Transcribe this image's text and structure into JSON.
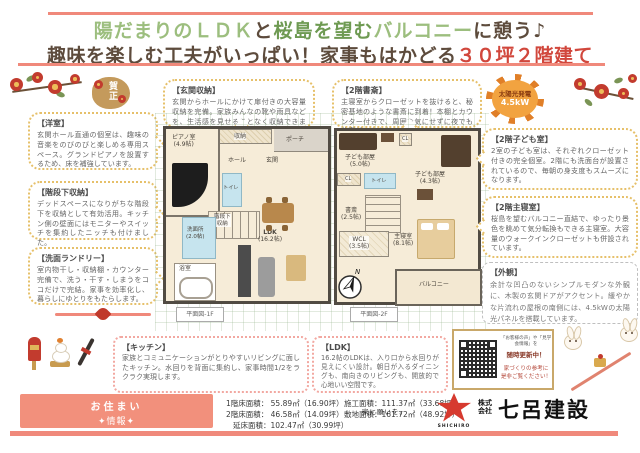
{
  "colors": {
    "accent_salmon": "#F0897B",
    "title_green": "#9CBE7E",
    "title_dark_green": "#6E9A52",
    "title_brown": "#5D4B3C",
    "highlight_red": "#D1473C",
    "brand_red": "#D63A2F"
  },
  "title": {
    "l1s1": "陽だまりの",
    "l1s2": "ＬＤＫ",
    "l1s3": "と",
    "l1s4": "桜島を望む",
    "l1s5": "バルコニー",
    "l1s6": "に憩う♪",
    "l2s1": "趣味を楽しむ工夫がいっぱい！家事もはかどる",
    "l2s2": "３０坪２階建て"
  },
  "seal": {
    "text": "賀正"
  },
  "solar": {
    "label": "太陽光発電",
    "value": "4.5kW"
  },
  "bubbles": {
    "genkan": {
      "title": "【玄関収納】",
      "body": "玄関からホールにかけて扉付きの大容量収納を完備。家族みんなの靴や雨具などを、生活感を見せることなく収納できます。"
    },
    "shosai": {
      "title": "【2階書斎】",
      "body": "主寝室からクローゼットを抜けると、秘密基地のような書斎に到着！本棚とカウンター付きで、周囲を気にせずに夜でも仕事ができます。"
    },
    "yoshitsu": {
      "title": "【洋室】",
      "body": "玄関ホール直通の個室は、趣味の音楽をのびのびと楽しめる専用スペース。グランドピアノを設置するため、床を補強しています。"
    },
    "kaidan": {
      "title": "【階段下収納】",
      "body": "デッドスペースになりがちな階段下を収納として有効活用。キッチン側の壁面にはモニターやスイッチを集約したニッチも付けました。"
    },
    "senmen": {
      "title": "【洗面ランドリー】",
      "body": "室内物干し・収納棚・カウンター完備で、洗う・干す・しまうをココだけで完結。家事を効率化し、暮らしにゆとりをもたらします。"
    },
    "kodomo": {
      "title": "【2階子ども室】",
      "body": "2室の子ども室は、それぞれクローゼット付きの完全個室。2階にも洗面台が設置されているので、毎朝の身支度もスムーズになります。"
    },
    "shinshitsu": {
      "title": "【2階主寝室】",
      "body": "桜島を望むバルコニー直結で、ゆったり景色を眺めて気分転換もできる主寝室。大容量のウォークインクローゼットも併設されています。"
    },
    "gaikan": {
      "title": "【外観】",
      "body": "余計な凹凸のないシンプルモダンな外観に、木製の玄関ドアがアクセント。緩やかな片流れの屋根の南側には、4.5kWの太陽光パネルを搭載しています。"
    },
    "kitchen": {
      "title": "【キッチン】",
      "body": "家族とコミュニケーションがとりやすいリビングに面したキッチン。水回りを背面に集約し、家事時間1/2をラクラク実現します。"
    },
    "ldk": {
      "title": "【LDK】",
      "body": "16.2帖のLDKは、入り口から水回りが見えにくい設計。朝日が入るダイニングも、南向きのリビングも、開放的で心地いい空間です。"
    }
  },
  "qr": {
    "line1": "「お客様の声」や「見学会情報」を",
    "line2": "随時更新中！",
    "line3": "家づくりの参考に",
    "line4": "是非ご覧ください！"
  },
  "plan1f": {
    "caption": "平面図-1F",
    "rooms": {
      "piano_name": "ピアノ室",
      "piano_size": "(4.9帖)",
      "closet": "収納",
      "porch": "ポーチ",
      "entrance": "玄関",
      "hall": "ホール",
      "toilet": "トイレ",
      "under_stairs1": "階段下",
      "under_stairs2": "収納",
      "washroom_name": "洗面所",
      "washroom_size": "(2.0帖)",
      "bath": "浴室",
      "ldk_name": "LDK",
      "ldk_size": "(16.2帖)"
    }
  },
  "plan2f": {
    "caption": "平面図-2F",
    "compass_n": "N",
    "rooms": {
      "kids1_name": "子ども部屋",
      "kids1_size": "(5.0帖)",
      "kids2_name": "子ども部屋",
      "kids2_size": "(4.3帖)",
      "cl1": "CL",
      "cl2": "CL",
      "toilet": "トイレ",
      "study_name": "書斎",
      "study_size": "(2.5帖)",
      "wcl_name": "WCL",
      "wcl_size": "(3.5帖)",
      "master_name": "主寝室",
      "master_size": "(8.1帖)",
      "balcony": "バルコニー"
    }
  },
  "footer": {
    "label_line1": "お住まい",
    "label_line2": "✦情報✦",
    "area_col1": [
      "1階床面積：  55.89㎡（16.90坪）",
      "2階床面積：  46.58㎡（14.09坪）",
      "延床面積：102.47㎡（30.99坪）"
    ],
    "area_col2": [
      "施工面積：111.37㎡（33.68坪）",
      "敷地面積：161.72㎡（48.92坪）"
    ],
    "logo": {
      "tagline": "家に願いを。",
      "brand_en": "SHICHIRO",
      "company_prefix1": "株式",
      "company_prefix2": "会社",
      "company": "七呂建設"
    }
  }
}
